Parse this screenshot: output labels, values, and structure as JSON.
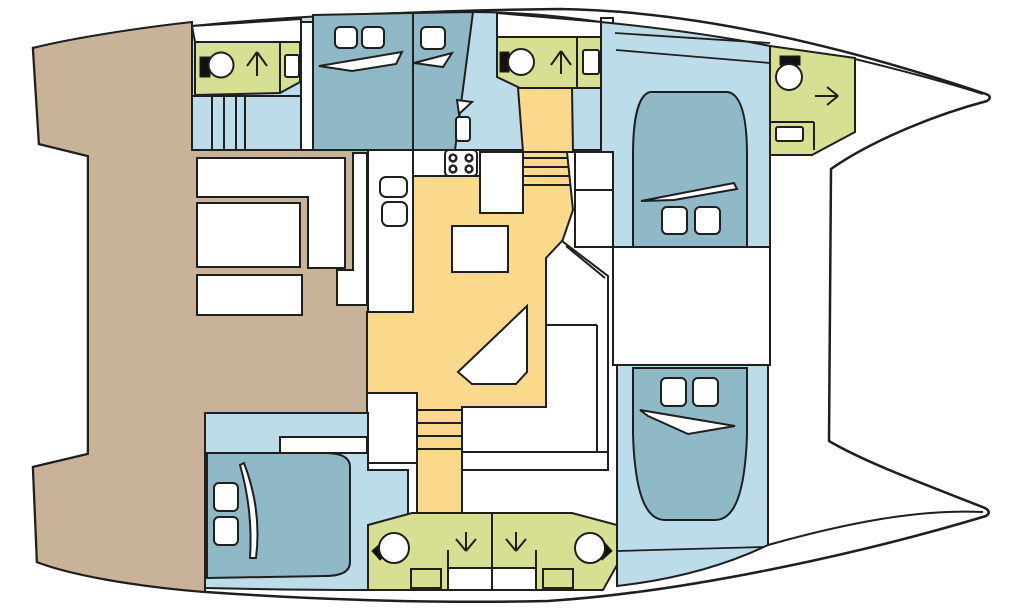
{
  "palette": {
    "background": "#ffffff",
    "outline": "#1f1f1f",
    "deck_tan": "#c8b298",
    "floor_blue": "#bcdcea",
    "berth_slate": "#8fb9c7",
    "bathroom_green": "#d6df92",
    "salon_yellow": "#fad98c",
    "fixture_white": "#ffffff",
    "fixture_black": "#111111"
  },
  "diagram": {
    "kind": "catamaran-yacht-floor-plan",
    "orientation": "bows-pointing-right",
    "areas": [
      {
        "id": "aft-deck-cockpit",
        "color_key": "deck_tan"
      },
      {
        "id": "port-hull-aft-head",
        "color_key": "bathroom_green"
      },
      {
        "id": "port-hull-steps",
        "color_key": "floor_blue"
      },
      {
        "id": "port-aft-double-cabin",
        "color_key": "berth_slate"
      },
      {
        "id": "port-single-cabin",
        "color_key": "berth_slate"
      },
      {
        "id": "port-mid-head",
        "color_key": "bathroom_green"
      },
      {
        "id": "port-forward-cabin",
        "color_key": "floor_blue"
      },
      {
        "id": "forepeak-head",
        "color_key": "bathroom_green"
      },
      {
        "id": "salon-galley",
        "color_key": "salon_yellow"
      },
      {
        "id": "mid-utility-room",
        "color_key": "background"
      },
      {
        "id": "starboard-aft-cabin",
        "color_key": "floor_blue"
      },
      {
        "id": "starboard-heads",
        "color_key": "bathroom_green"
      },
      {
        "id": "starboard-forward-cabin",
        "color_key": "floor_blue"
      }
    ],
    "fixtures": [
      "toilet-icon",
      "shower-arrow-icon",
      "sink-icon",
      "stove-icon",
      "galley-sink-icon",
      "bed-pillow-icon",
      "bed-sheet-icon",
      "table-icon",
      "settee-icon",
      "stairs-icon",
      "cockpit-bench-icon"
    ]
  }
}
